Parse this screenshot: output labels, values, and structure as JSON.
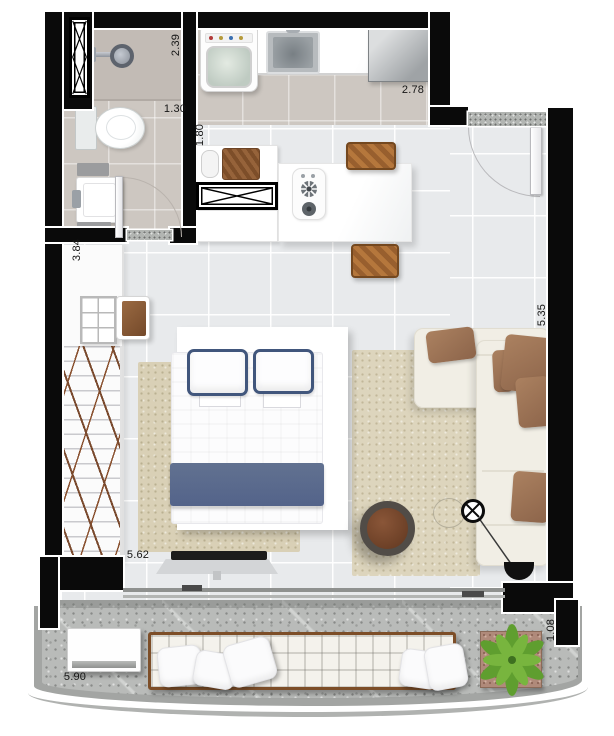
{
  "floorplan": {
    "title": "studio-apartment-floor-plan",
    "dimensions": {
      "bathroom_length": "2.39",
      "bathroom_width": "1.30",
      "kitchen_corridor": "1.80",
      "kitchen_width": "2.78",
      "closet_wall": "3.84",
      "living_wall": "5.35",
      "living_length": "5.62",
      "balcony_length": "5.90",
      "balcony_depth": "1.08"
    },
    "rooms": [
      "bathroom",
      "laundry-kitchen",
      "living-sleeping-area",
      "closet",
      "balcony"
    ],
    "colors": {
      "wall": "#0a0a0a",
      "living_floor": "#e8eaec",
      "service_floor": "#cdc7c1",
      "balcony_floor": "#b9bbb9",
      "bed_accent_blue": "#5a6a8a",
      "pillow_trim_blue": "#41567c",
      "sofa_body": "#f1eee5",
      "cushion_brown": "#9c7256",
      "wood_brown": "#b5773c",
      "rug_beige": "#d9d0b6",
      "plant_green": "#64a433"
    }
  }
}
